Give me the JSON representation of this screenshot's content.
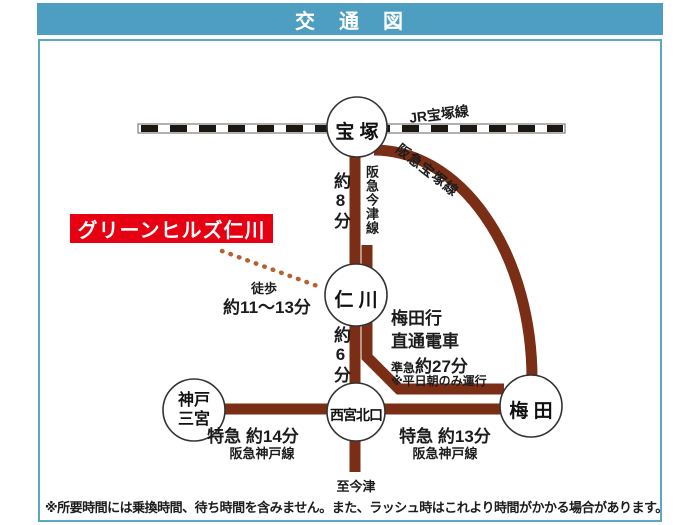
{
  "header": {
    "title": "交　通　図"
  },
  "colors": {
    "header_teal": "#4d9ec0",
    "box_border_teal": "#5aa7c6",
    "rail_brown": "#7a2e16",
    "property_red": "#e60012",
    "walk_dots_orange": "#b4612f",
    "jr_track_black": "#1d1712"
  },
  "stations": {
    "takarazuka": "宝 塚",
    "nigawa": "仁 川",
    "nishinomiya_kitaguchi": "西宮北口",
    "kobe_sannomiya_line1": "神戸",
    "kobe_sannomiya_line2": "三宮",
    "umeda": "梅 田"
  },
  "lines": {
    "jr_takarazuka": "JR宝塚線",
    "hankyu_takarazuka": "阪急宝塚線",
    "hankyu_imazu": "阪急今津線",
    "hankyu_kobe_west": "阪急神戸線",
    "hankyu_kobe_east": "阪急神戸線"
  },
  "labels": {
    "property_name": "グリーンヒルズ仁川",
    "walk": "徒歩",
    "walk_time": "約11～13分",
    "takarazuka_to_nigawa": "約8分",
    "nigawa_to_nishikita": "約6分",
    "umeda_bound_line1": "梅田行",
    "umeda_bound_line2": "直通電車",
    "semi_express": "準急",
    "semi_express_time": "約27分",
    "weekday_only_note": "※平日朝のみ運行",
    "express_west": "特急 約14分",
    "express_east": "特急 約13分",
    "to_imazu": "至今津"
  },
  "footer": {
    "note": "※所要時間には乗換時間、待ち時間を含みません。また、ラッシュ時はこれより時間がかかる場合があります。"
  }
}
